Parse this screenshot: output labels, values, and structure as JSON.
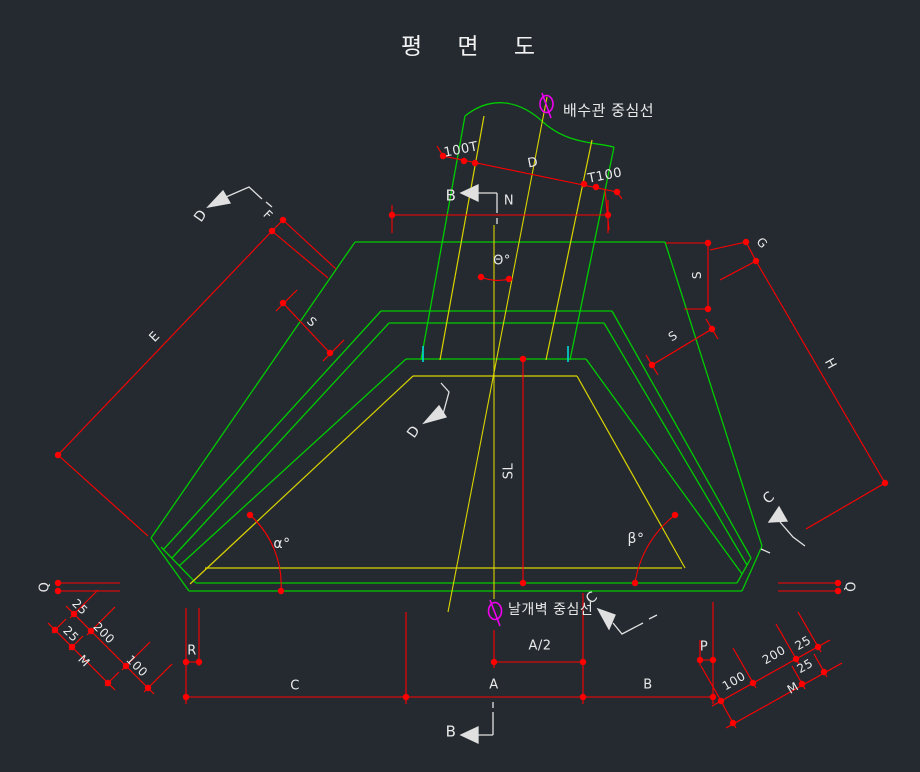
{
  "title": "평 면 도",
  "colors": {
    "background": "#252a31",
    "structure_green": "#00cc00",
    "hidden_yellow": "#d9d400",
    "dimension_red": "#ff0000",
    "intersection_cyan": "#00d8d8",
    "centerline_magenta": "#ee00ee",
    "text_white": "#e9e9e9"
  },
  "centerlines": {
    "pipe": "배수관 중심선",
    "wall": "날개벽 중심선"
  },
  "labels": [
    {
      "name": "pipe-centerline-label",
      "text": "배수관 중심선",
      "x": 563,
      "y": 111,
      "rot": 0,
      "size": 15,
      "anchor": "start"
    },
    {
      "name": "wall-centerline-label",
      "text": "날개벽 중심선",
      "x": 508,
      "y": 610,
      "rot": 0,
      "size": 14,
      "anchor": "start"
    },
    {
      "name": "dim-100T",
      "text": "100T",
      "x": 461,
      "y": 150,
      "rot": -11,
      "size": 13
    },
    {
      "name": "dim-pipe-D",
      "text": "D",
      "x": 533,
      "y": 163,
      "rot": -11,
      "size": 13
    },
    {
      "name": "dim-T100",
      "text": "T100",
      "x": 605,
      "y": 176,
      "rot": -11,
      "size": 13
    },
    {
      "name": "section-B-top-label",
      "text": "B",
      "x": 451,
      "y": 196,
      "rot": 0,
      "size": 15
    },
    {
      "name": "dim-N",
      "text": "N",
      "x": 509,
      "y": 201,
      "rot": 0,
      "size": 13
    },
    {
      "name": "dim-theta",
      "text": "Θ°",
      "x": 502,
      "y": 261,
      "rot": 0,
      "size": 13
    },
    {
      "name": "section-D-topleft-label",
      "text": "D",
      "x": 201,
      "y": 216,
      "rot": -55,
      "size": 14
    },
    {
      "name": "dim-F",
      "text": "F",
      "x": 268,
      "y": 215,
      "rot": 44,
      "size": 12
    },
    {
      "name": "dim-E",
      "text": "E",
      "x": 155,
      "y": 337,
      "rot": -46,
      "size": 13
    },
    {
      "name": "dim-S-left",
      "text": "S",
      "x": 312,
      "y": 322,
      "rot": 44,
      "size": 12
    },
    {
      "name": "dim-G",
      "text": "G",
      "x": 762,
      "y": 243,
      "rot": 47,
      "size": 12
    },
    {
      "name": "dim-S-right",
      "text": "S",
      "x": 697,
      "y": 275,
      "rot": -90,
      "size": 12
    },
    {
      "name": "dim-S-right-lower",
      "text": "S",
      "x": 673,
      "y": 336,
      "rot": -33,
      "size": 12
    },
    {
      "name": "dim-H",
      "text": "H",
      "x": 830,
      "y": 364,
      "rot": 61,
      "size": 13
    },
    {
      "name": "section-D-mid-label",
      "text": "D",
      "x": 414,
      "y": 432,
      "rot": -55,
      "size": 14
    },
    {
      "name": "dim-SL",
      "text": "SL",
      "x": 509,
      "y": 471,
      "rot": -90,
      "size": 13
    },
    {
      "name": "dim-alpha",
      "text": "α°",
      "x": 282,
      "y": 544,
      "rot": 0,
      "size": 14
    },
    {
      "name": "dim-beta",
      "text": "β°",
      "x": 636,
      "y": 539,
      "rot": 0,
      "size": 14
    },
    {
      "name": "section-C-right-label",
      "text": "C",
      "x": 769,
      "y": 498,
      "rot": -40,
      "size": 14
    },
    {
      "name": "section-C-bottom-label",
      "text": "C",
      "x": 592,
      "y": 598,
      "rot": -40,
      "size": 14
    },
    {
      "name": "dim-A2",
      "text": "A/2",
      "x": 540,
      "y": 646,
      "rot": 0,
      "size": 13
    },
    {
      "name": "dim-A",
      "text": "A",
      "x": 494,
      "y": 685,
      "rot": 0,
      "size": 13
    },
    {
      "name": "dim-B",
      "text": "B",
      "x": 648,
      "y": 685,
      "rot": 0,
      "size": 13
    },
    {
      "name": "dim-C",
      "text": "C",
      "x": 295,
      "y": 686,
      "rot": 0,
      "size": 13
    },
    {
      "name": "dim-R",
      "text": "R",
      "x": 192,
      "y": 651,
      "rot": 0,
      "size": 13
    },
    {
      "name": "dim-P",
      "text": "P",
      "x": 704,
      "y": 647,
      "rot": 0,
      "size": 13
    },
    {
      "name": "dim-Q-left",
      "text": "Q",
      "x": 45,
      "y": 587,
      "rot": -90,
      "size": 13
    },
    {
      "name": "dim-Q-right",
      "text": "Q",
      "x": 849,
      "y": 587,
      "rot": 90,
      "size": 13
    },
    {
      "name": "dim-25-left-1",
      "text": "25",
      "x": 80,
      "y": 607,
      "rot": 45,
      "size": 12
    },
    {
      "name": "dim-200-left",
      "text": "200",
      "x": 104,
      "y": 633,
      "rot": 45,
      "size": 12
    },
    {
      "name": "dim-100-left",
      "text": "100",
      "x": 137,
      "y": 666,
      "rot": 45,
      "size": 12
    },
    {
      "name": "dim-25-left-2",
      "text": "25",
      "x": 71,
      "y": 634,
      "rot": 45,
      "size": 12
    },
    {
      "name": "dim-M-left",
      "text": "M",
      "x": 84,
      "y": 661,
      "rot": 45,
      "size": 12
    },
    {
      "name": "dim-100-right",
      "text": "100",
      "x": 734,
      "y": 681,
      "rot": -30,
      "size": 12
    },
    {
      "name": "dim-200-right",
      "text": "200",
      "x": 774,
      "y": 655,
      "rot": -30,
      "size": 12
    },
    {
      "name": "dim-25-right-1",
      "text": "25",
      "x": 803,
      "y": 643,
      "rot": -30,
      "size": 12
    },
    {
      "name": "dim-25-right-2",
      "text": "25",
      "x": 805,
      "y": 666,
      "rot": -30,
      "size": 12
    },
    {
      "name": "dim-M-right",
      "text": "M",
      "x": 793,
      "y": 688,
      "rot": -30,
      "size": 12
    },
    {
      "name": "section-B-bottom-label",
      "text": "B",
      "x": 451,
      "y": 732,
      "rot": 0,
      "size": 15
    }
  ]
}
